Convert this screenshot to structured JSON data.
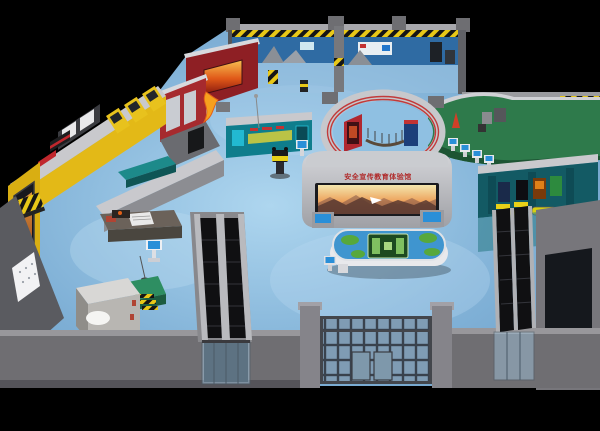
{
  "scene": {
    "description": "Isometric 3D render of a public safety education exhibition hall floor",
    "background": "#000000"
  },
  "signage": {
    "led_wall_text": "安全宣传教育体验馆",
    "led_wall_text_color": "#b02a2a"
  },
  "colors": {
    "floor_light": "#aed6ef",
    "floor_mid": "#7fb0d6",
    "floor_dark": "#6b9cc4",
    "wall_cap": "#c9c9cd",
    "wall_face": "#8c8d92",
    "wall_outer": "#6f6e72",
    "zone_yellow": "#e3b917",
    "zone_red": "#a62a2e",
    "zone_red_dark": "#8e1f24",
    "zone_blue_wall": "#2f6ba3",
    "zone_teal_booth": "#0f7d8c",
    "zone_green": "#2e7a4b",
    "zone_poster_room": "#135a64",
    "ring_stripe_red": "#c23a3a",
    "hazard_yellow": "#e8c818",
    "escalator_black": "#101012",
    "glass_pane": "#7f9cb4",
    "map_table_blue": "#3f95cf",
    "map_green": "#57a83c",
    "screen_blue": "#2a8fd8",
    "bench_yellow": "#d8cf10"
  }
}
